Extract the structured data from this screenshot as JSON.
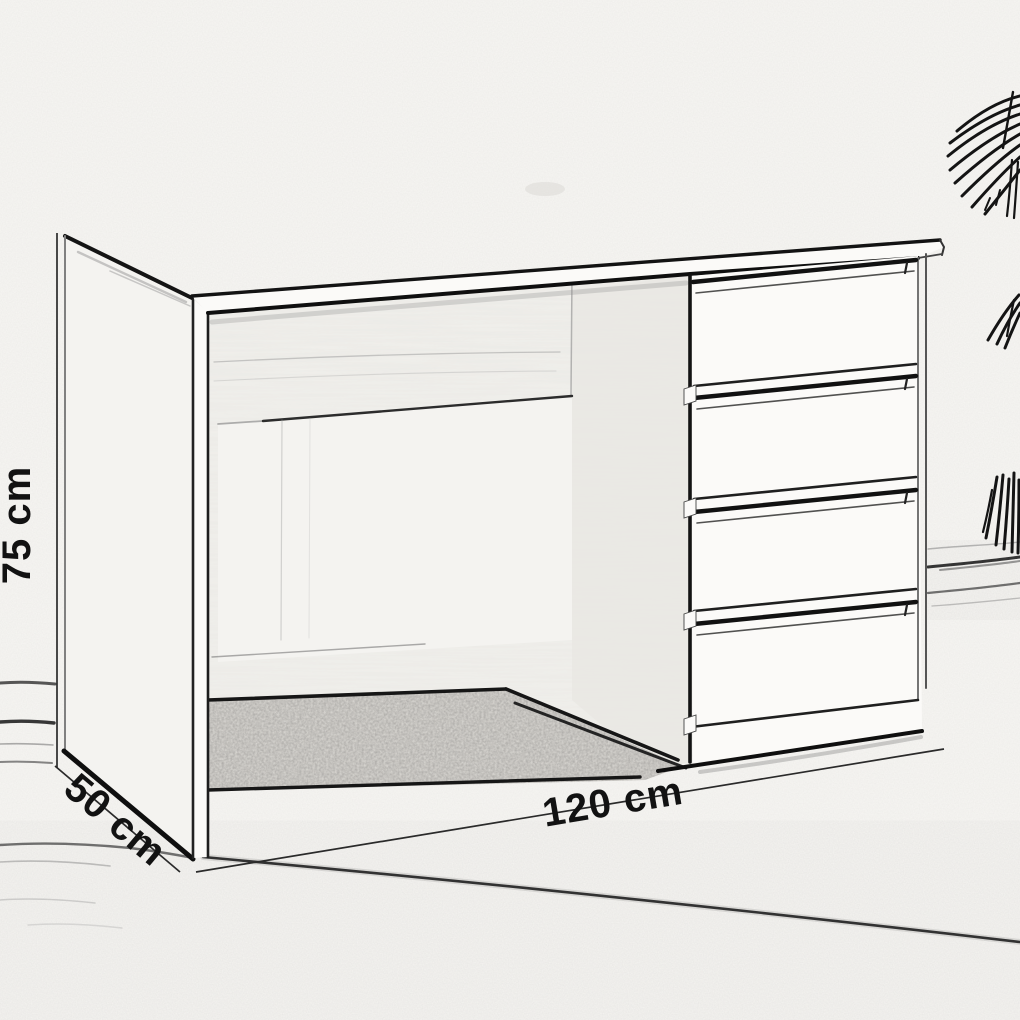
{
  "sketch": {
    "subject": "pencil-sketch of a desk with four drawers and a palm plant",
    "dimensions": {
      "height_label": "75 cm",
      "depth_label": "50 cm",
      "width_label": "120 cm"
    },
    "drawer_count": 4,
    "colors": {
      "ink": "#1a1a1a",
      "paper": "#f7f6f3",
      "carpet_gray": "#8f8d89"
    }
  }
}
